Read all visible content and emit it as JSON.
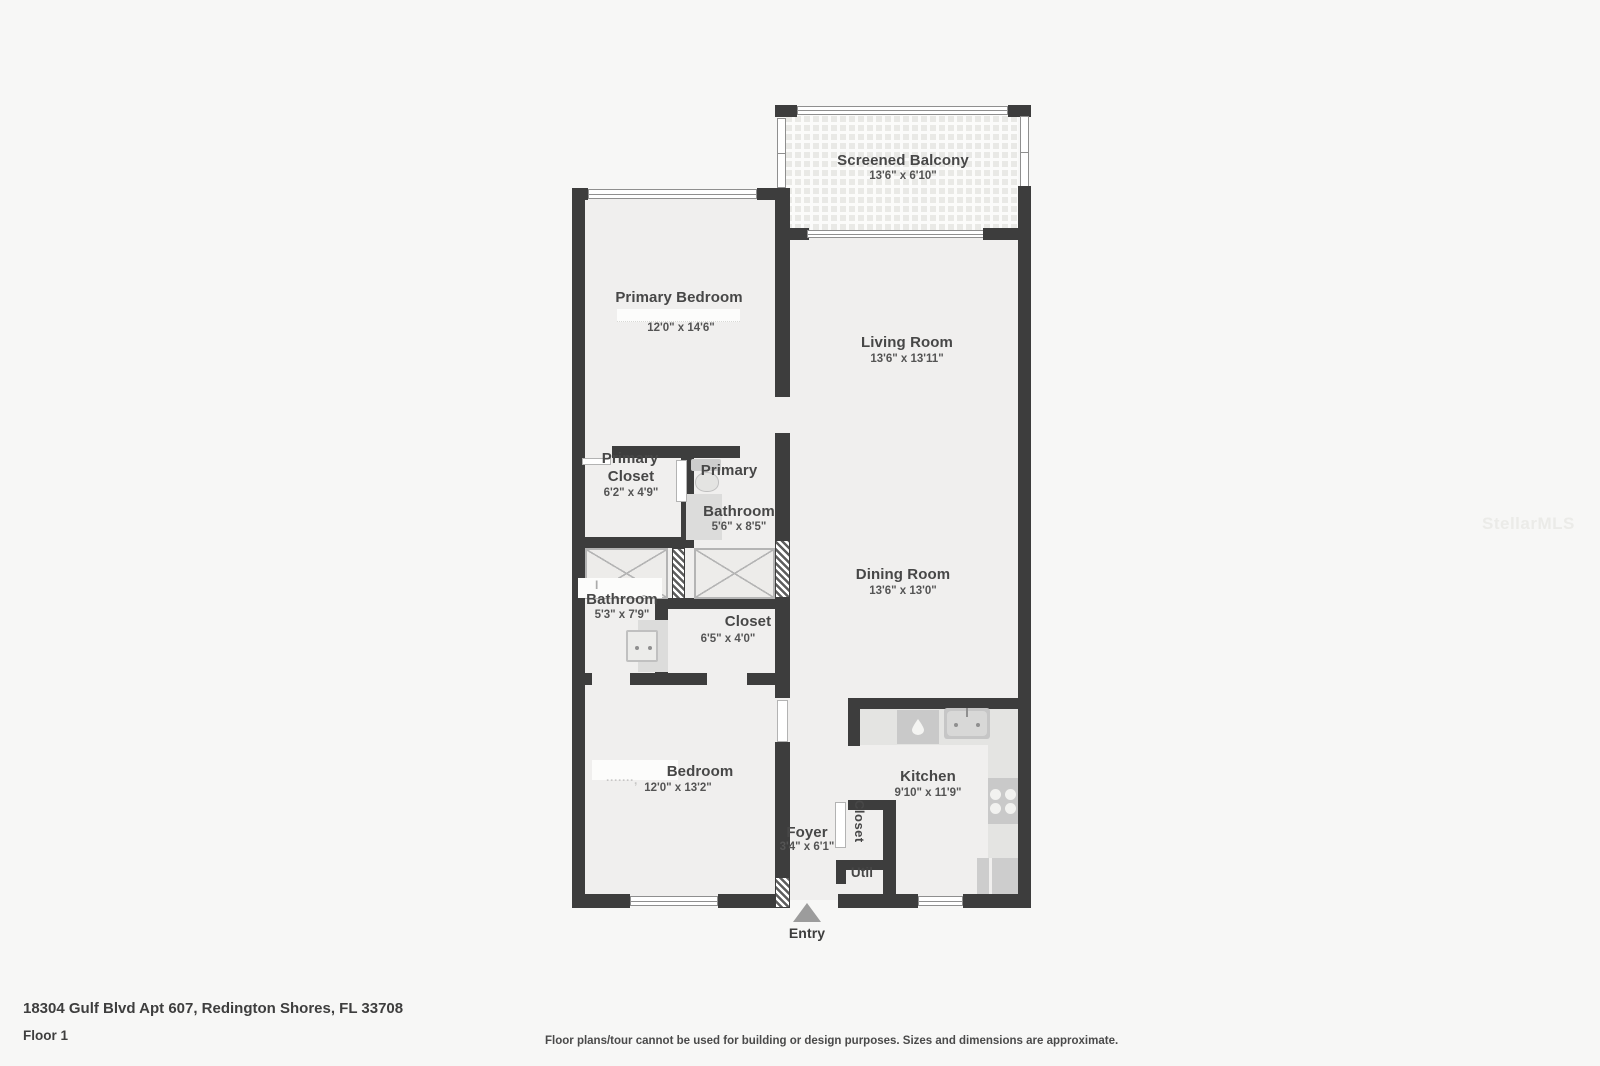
{
  "watermark": "StellarMLS",
  "footer": {
    "address": "18304 Gulf Blvd Apt 607, Redington Shores, FL 33708",
    "floor": "Floor 1",
    "disclaimer": "Floor plans/tour cannot be used for building or design purposes. Sizes and dimensions are approximate."
  },
  "entry": {
    "label": "Entry"
  },
  "rooms": {
    "screened_balcony": {
      "name": "Screened Balcony",
      "dims": "13'6\" x 6'10\""
    },
    "primary_bedroom": {
      "name": "Primary Bedroom",
      "dims": "12'0\" x 14'6\""
    },
    "living_room": {
      "name": "Living Room",
      "dims": "13'6\" x 13'11\""
    },
    "primary_closet": {
      "name_line1": "Primary",
      "name_line2": "Closet",
      "dims": "6'2\" x 4'9\""
    },
    "primary_bathroom": {
      "name_line1": "Primary",
      "name_line2": "Bathroom",
      "dims": "5'6\" x 8'5\""
    },
    "bathroom": {
      "name": "Bathroom",
      "dims": "5'3\" x 7'9\"",
      "remnant_left": "I",
      "remnant_right": "-"
    },
    "closet": {
      "name": "Closet",
      "dims": "6'5\" x 4'0\""
    },
    "dining_room": {
      "name": "Dining Room",
      "dims": "13'6\" x 13'0\""
    },
    "bedroom": {
      "name": "Bedroom",
      "dims": "12'0\" x 13'2\"",
      "remnant": "·······,"
    },
    "kitchen": {
      "name": "Kitchen",
      "dims": "9'10\" x 11'9\""
    },
    "foyer": {
      "name": "Foyer",
      "dims": "3'4\" x 6'1\""
    },
    "hall_closet": {
      "name": "Closet"
    },
    "util": {
      "name": "Util"
    }
  }
}
